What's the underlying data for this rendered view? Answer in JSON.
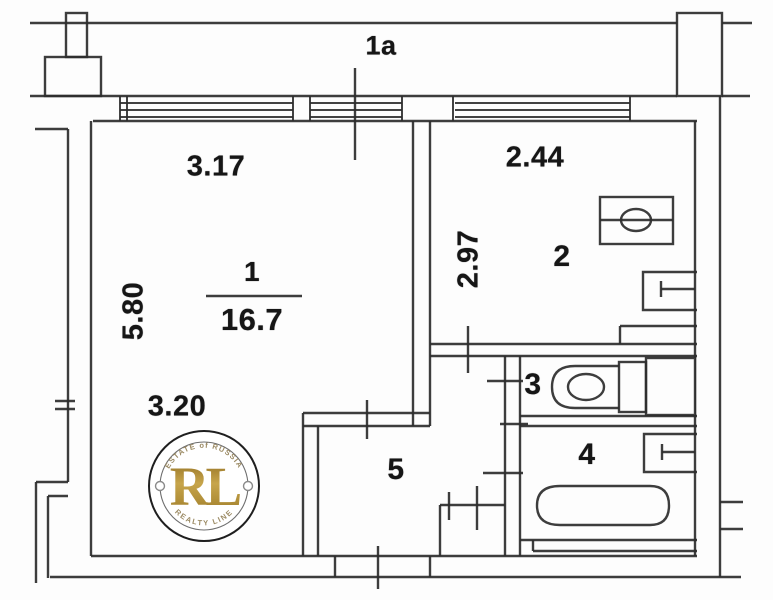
{
  "balcony": {
    "label": "1a"
  },
  "rooms": {
    "living": {
      "number": "1",
      "area": "16.7"
    },
    "kitchen": {
      "number": "2"
    },
    "wc": {
      "number": "3"
    },
    "bathroom": {
      "number": "4"
    },
    "hallway": {
      "number": "5"
    }
  },
  "dimensions": {
    "living_width_top": "3.17",
    "living_depth": "5.80",
    "living_width_bottom": "3.20",
    "kitchen_width": "2.44",
    "kitchen_depth": "2.97"
  },
  "watermark": {
    "arc_top": "ESTATE of RUSSIA",
    "monogram": "RL",
    "arc_bottom": "REALTY LINE",
    "gold_color": "#b3913f",
    "line_color": "#2d2d2d"
  }
}
